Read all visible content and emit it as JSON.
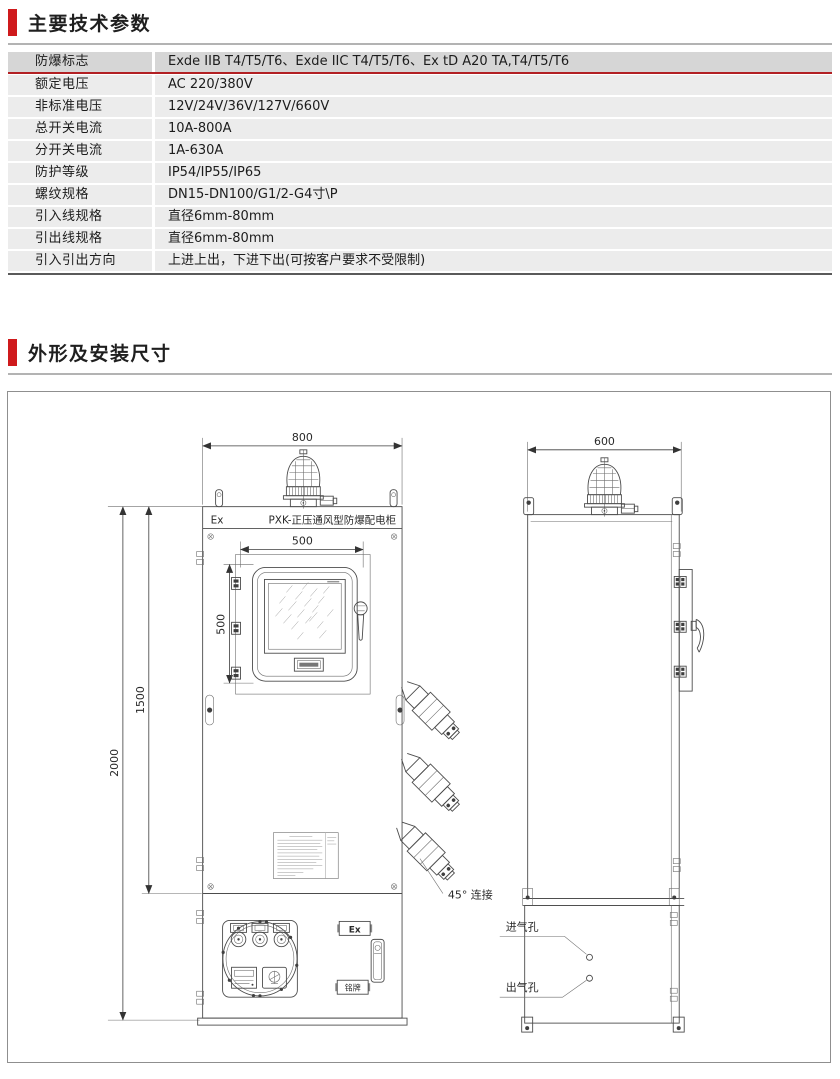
{
  "colors": {
    "accent_red": "#cf1a1c",
    "table_header_row_bg": "#d6d6d6",
    "table_row_bg": "#ececec",
    "red_divider": "#b22023"
  },
  "section_params": {
    "title": "主要技术参数"
  },
  "section_dims": {
    "title": "外形及安装尺寸"
  },
  "params_table": {
    "rows": [
      {
        "label": "防爆标志",
        "value": "Exde IIB T4/T5/T6、Exde IIC T4/T5/T6、Ex tD A20 TA,T4/T5/T6"
      },
      {
        "label": "额定电压",
        "value": "AC 220/380V"
      },
      {
        "label": "非标准电压",
        "value": "12V/24V/36V/127V/660V"
      },
      {
        "label": "总开关电流",
        "value": "10A-800A"
      },
      {
        "label": "分开关电流",
        "value": "1A-630A"
      },
      {
        "label": "防护等级",
        "value": "IP54/IP55/IP65"
      },
      {
        "label": "螺纹规格",
        "value": "DN15-DN100/G1/2-G4寸\\P"
      },
      {
        "label": "引入线规格",
        "value": "直径6mm-80mm"
      },
      {
        "label": "引出线规格",
        "value": "直径6mm-80mm"
      },
      {
        "label": "引入引出方向",
        "value": "上进上出，下进下出(可按客户要求不受限制)"
      }
    ]
  },
  "drawing": {
    "front_view": {
      "top_width_dim": "800",
      "overall_height_dim": "2000",
      "upper_height_dim": "1500",
      "window_width_dim": "500",
      "window_height_dim": "500",
      "band_ex_mark": "Ex",
      "band_title": "PXK-正压通风型防爆配电柜",
      "ex_plate": "Ex",
      "nameplate_plate": "铭牌",
      "gland_label": "45° 连接"
    },
    "side_view": {
      "top_depth_dim": "600",
      "air_inlet_label": "进气孔",
      "air_outlet_label": "出气孔"
    }
  }
}
